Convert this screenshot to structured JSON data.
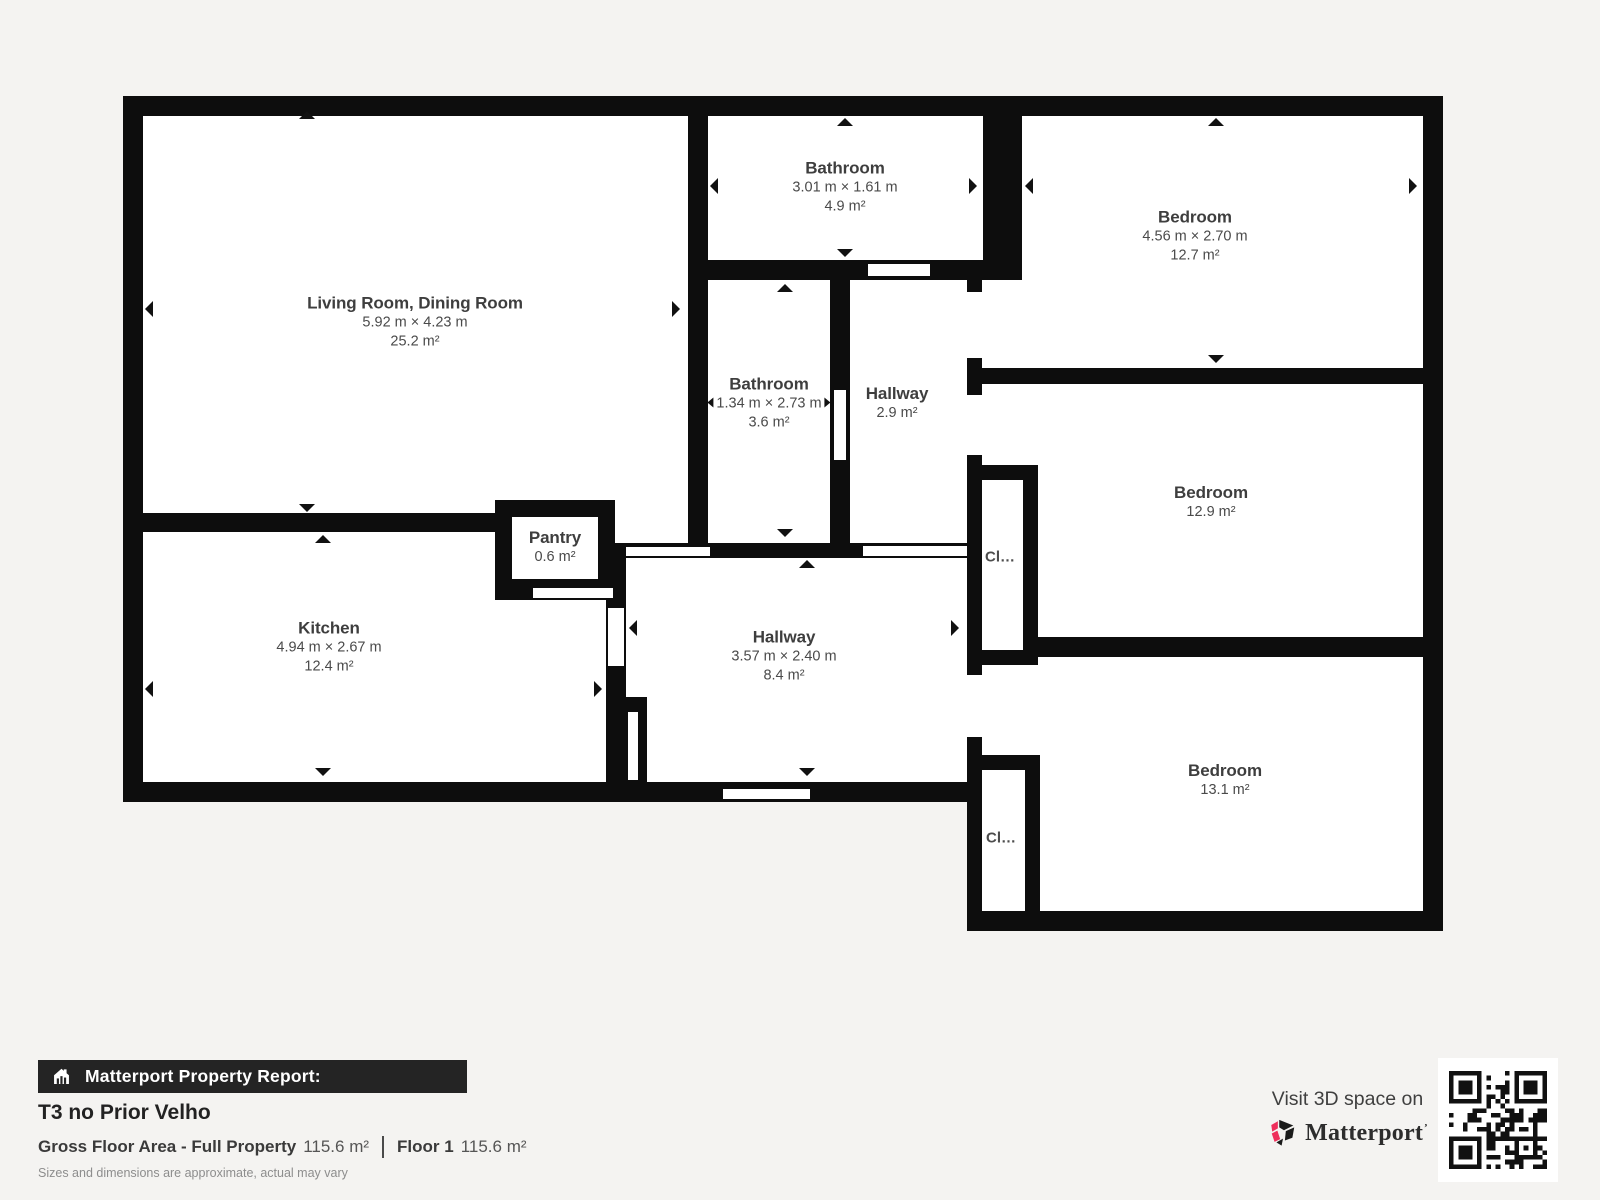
{
  "report": {
    "banner_label": "Matterport Property Report:",
    "property_title": "T3 no Prior Velho",
    "gross_floor_area_label": "Gross Floor Area - Full Property",
    "gross_floor_area_value": "115.6 m²",
    "floor_label": "Floor 1",
    "floor_area_value": "115.6 m²",
    "disclaimer": "Sizes and dimensions are approximate, actual may vary"
  },
  "promo": {
    "visit_text": "Visit 3D space on",
    "brand_name": "Matterport"
  },
  "rooms": {
    "living": {
      "name": "Living Room, Dining Room",
      "dims": "5.92 m × 4.23 m",
      "area": "25.2 m²"
    },
    "bathroom_top": {
      "name": "Bathroom",
      "dims": "3.01 m × 1.61 m",
      "area": "4.9 m²"
    },
    "bedroom_top": {
      "name": "Bedroom",
      "dims": "4.56 m × 2.70 m",
      "area": "12.7 m²"
    },
    "bathroom_mid": {
      "name": "Bathroom",
      "dims": "1.34 m × 2.73 m",
      "area": "3.6 m²"
    },
    "hallway_small": {
      "name": "Hallway",
      "area": "2.9 m²"
    },
    "bedroom_mid": {
      "name": "Bedroom",
      "area": "12.9 m²"
    },
    "kitchen": {
      "name": "Kitchen",
      "dims": "4.94 m × 2.67 m",
      "area": "12.4 m²"
    },
    "pantry": {
      "name": "Pantry",
      "area": "0.6 m²"
    },
    "hallway_main": {
      "name": "Hallway",
      "dims": "3.57 m × 2.40 m",
      "area": "8.4 m²"
    },
    "bedroom_bottom": {
      "name": "Bedroom",
      "area": "13.1 m²"
    },
    "closet_mid": {
      "name": "Cl…"
    },
    "closet_bottom": {
      "name": "Cl…"
    }
  },
  "colors": {
    "wall": "#0d0d0d",
    "background": "#f4f3f1",
    "banner_background": "#242424",
    "brand_red": "#ee2e5b"
  }
}
